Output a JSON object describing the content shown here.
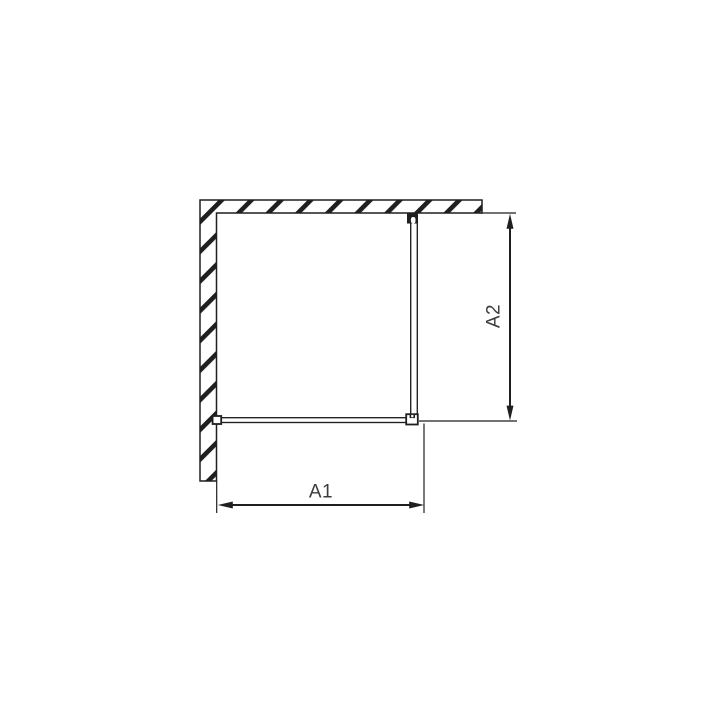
{
  "page": {
    "background_color": "#ffffff"
  },
  "diagram": {
    "kind": "technical-dimension-drawing",
    "line_color": "#1f1f1f",
    "label_color": "#3c3c3c",
    "dimension_labels": {
      "a1": "A1",
      "a2": "A2"
    },
    "shapes": [
      "hatched-wall-l-shape",
      "glass-panel-vertical",
      "glass-panel-horizontal",
      "wall-profile-bracket",
      "top-mount-bracket",
      "corner-connector-bracket",
      "dimension-a1-horizontal",
      "dimension-a2-vertical"
    ]
  }
}
